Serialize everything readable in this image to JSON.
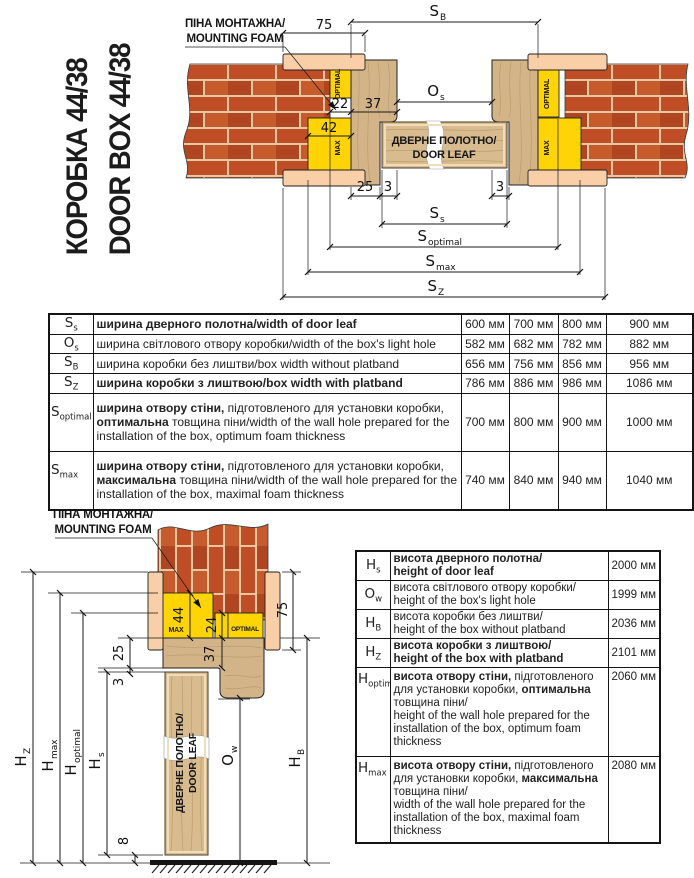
{
  "title": {
    "line1": "КОРОБКА 44/38",
    "line2": "DOOR BOX 44/38"
  },
  "labels": {
    "foam1": "ПІНА МОНТАЖНА/",
    "foam2": "MOUNTING FOAM",
    "leaf1": "ДВЕРНЕ ПОЛОТНО/",
    "leaf2": "DOOR LEAF",
    "optimal": "OPTIMAL",
    "max": "MAX"
  },
  "colors": {
    "foam_yellow": "#ffd405",
    "brick": "#bf4e27",
    "mortar": "#e7c9a1",
    "platband": "#f9cfa8",
    "wood": "#d2b488"
  },
  "top_diagram": {
    "d75": "75",
    "d22": "22",
    "d37": "37",
    "d42": "42",
    "d25": "25",
    "d3_left": "3",
    "d3_right": "3",
    "SB": {
      "sym": "S",
      "sub": "B"
    },
    "Os": {
      "sym": "O",
      "sub": "s"
    },
    "Ss": {
      "sym": "S",
      "sub": "s"
    },
    "Sopt": {
      "sym": "S",
      "sub": "optimal"
    },
    "Smax": {
      "sym": "S",
      "sub": "max"
    },
    "Sz": {
      "sym": "S",
      "sub": "Z"
    }
  },
  "bottom_diagram": {
    "d75": "75",
    "d44": "44",
    "d24": "24",
    "d37": "37",
    "d25": "25",
    "d3": "3",
    "d8": "8",
    "Hz": {
      "sym": "H",
      "sub": "Z"
    },
    "Hmax": {
      "sym": "H",
      "sub": "max"
    },
    "Hopt": {
      "sym": "H",
      "sub": "optimal"
    },
    "Hs": {
      "sym": "H",
      "sub": "s"
    },
    "Ow": {
      "sym": "O",
      "sub": "w"
    },
    "HB": {
      "sym": "H",
      "sub": "B"
    }
  },
  "width_table": {
    "rows": [
      {
        "sym": "S",
        "sub": "s",
        "desc": [
          [
            {
              "t": "ширина дверного полотна/width of door leaf",
              "b": 1
            }
          ]
        ],
        "values": [
          "600 мм",
          "700 мм",
          "800 мм",
          "900 мм"
        ]
      },
      {
        "sym": "O",
        "sub": "s",
        "desc": [
          [
            {
              "t": "ширина світлового отвору коробки/width of the box's light hole"
            }
          ]
        ],
        "values": [
          "582 мм",
          "682 мм",
          "782 мм",
          "882 мм"
        ]
      },
      {
        "sym": "S",
        "sub": "B",
        "desc": [
          [
            {
              "t": "ширина коробки без лиштви/box width without platband"
            }
          ]
        ],
        "values": [
          "656 мм",
          "756 мм",
          "856 мм",
          "956 мм"
        ]
      },
      {
        "sym": "S",
        "sub": "Z",
        "desc": [
          [
            {
              "t": "ширина коробки з лиштвою/box width with platband",
              "b": 1
            }
          ]
        ],
        "values": [
          "786 мм",
          "886 мм",
          "986 мм",
          "1086 мм"
        ]
      },
      {
        "sym": "S",
        "sub": "optimal",
        "desc": [
          [
            {
              "t": "ширина отвору стіни,",
              "b": 1
            },
            {
              "t": " підготовленого для установки коробки,"
            }
          ],
          [
            {
              "t": "оптимальна",
              "b": 1
            },
            {
              "t": " товщина піни/width of the wall hole prepared for the"
            }
          ],
          [
            {
              "t": "installation of the box, optimum foam thickness"
            }
          ]
        ],
        "values": [
          "700 мм",
          "800 мм",
          "900 мм",
          "1000 мм"
        ]
      },
      {
        "sym": "S",
        "sub": "max",
        "desc": [
          [
            {
              "t": "ширина отвору стіни,",
              "b": 1
            },
            {
              "t": " підготовленого для установки коробки,"
            }
          ],
          [
            {
              "t": "максимальна",
              "b": 1
            },
            {
              "t": " товщина піни/width of the wall hole prepared for the"
            }
          ],
          [
            {
              "t": "installation of the box, maximal foam thickness"
            }
          ]
        ],
        "values": [
          "740 мм",
          "840 мм",
          "940 мм",
          "1040 мм"
        ]
      }
    ]
  },
  "height_table": {
    "rows": [
      {
        "sym": "H",
        "sub": "s",
        "desc": [
          [
            {
              "t": "висота дверного полотна/",
              "b": 1
            }
          ],
          [
            {
              "t": "height of door leaf",
              "b": 1
            }
          ]
        ],
        "values": [
          "2000 мм"
        ]
      },
      {
        "sym": "O",
        "sub": "w",
        "desc": [
          [
            {
              "t": "висота світлового отвору коробки/"
            }
          ],
          [
            {
              "t": "height of the box's light hole"
            }
          ]
        ],
        "values": [
          "1999 мм"
        ]
      },
      {
        "sym": "H",
        "sub": "B",
        "desc": [
          [
            {
              "t": "висота коробки без лиштви/"
            }
          ],
          [
            {
              "t": "height of the box without platband"
            }
          ]
        ],
        "values": [
          "2036 мм"
        ]
      },
      {
        "sym": "H",
        "sub": "Z",
        "desc": [
          [
            {
              "t": "висота коробки з лиштвою/",
              "b": 1
            }
          ],
          [
            {
              "t": "height of the box with platband",
              "b": 1
            }
          ]
        ],
        "values": [
          "2101 мм"
        ]
      },
      {
        "sym": "H",
        "sub": "optimal",
        "desc": [
          [
            {
              "t": "висота отвору стіни,",
              "b": 1
            },
            {
              "t": " підготовленого"
            }
          ],
          [
            {
              "t": "для установки коробки, "
            },
            {
              "t": "оптимальна",
              "b": 1
            }
          ],
          [
            {
              "t": "товщина піни/"
            }
          ],
          [
            {
              "t": "height of the wall hole prepared for the"
            }
          ],
          [
            {
              "t": "installation of the box, optimum foam"
            }
          ],
          [
            {
              "t": "thickness"
            }
          ]
        ],
        "values": [
          "2060 мм"
        ]
      },
      {
        "sym": "H",
        "sub": "max",
        "desc": [
          [
            {
              "t": "висота отвору стіни,",
              "b": 1
            },
            {
              "t": " підготовленого"
            }
          ],
          [
            {
              "t": "для установки коробки, "
            },
            {
              "t": "максимальна",
              "b": 1
            }
          ],
          [
            {
              "t": "товщина піни/"
            }
          ],
          [
            {
              "t": "width of the wall hole prepared for the"
            }
          ],
          [
            {
              "t": "installation of the box, maximal foam"
            }
          ],
          [
            {
              "t": "thickness"
            }
          ]
        ],
        "values": [
          "2080 мм"
        ]
      }
    ]
  }
}
